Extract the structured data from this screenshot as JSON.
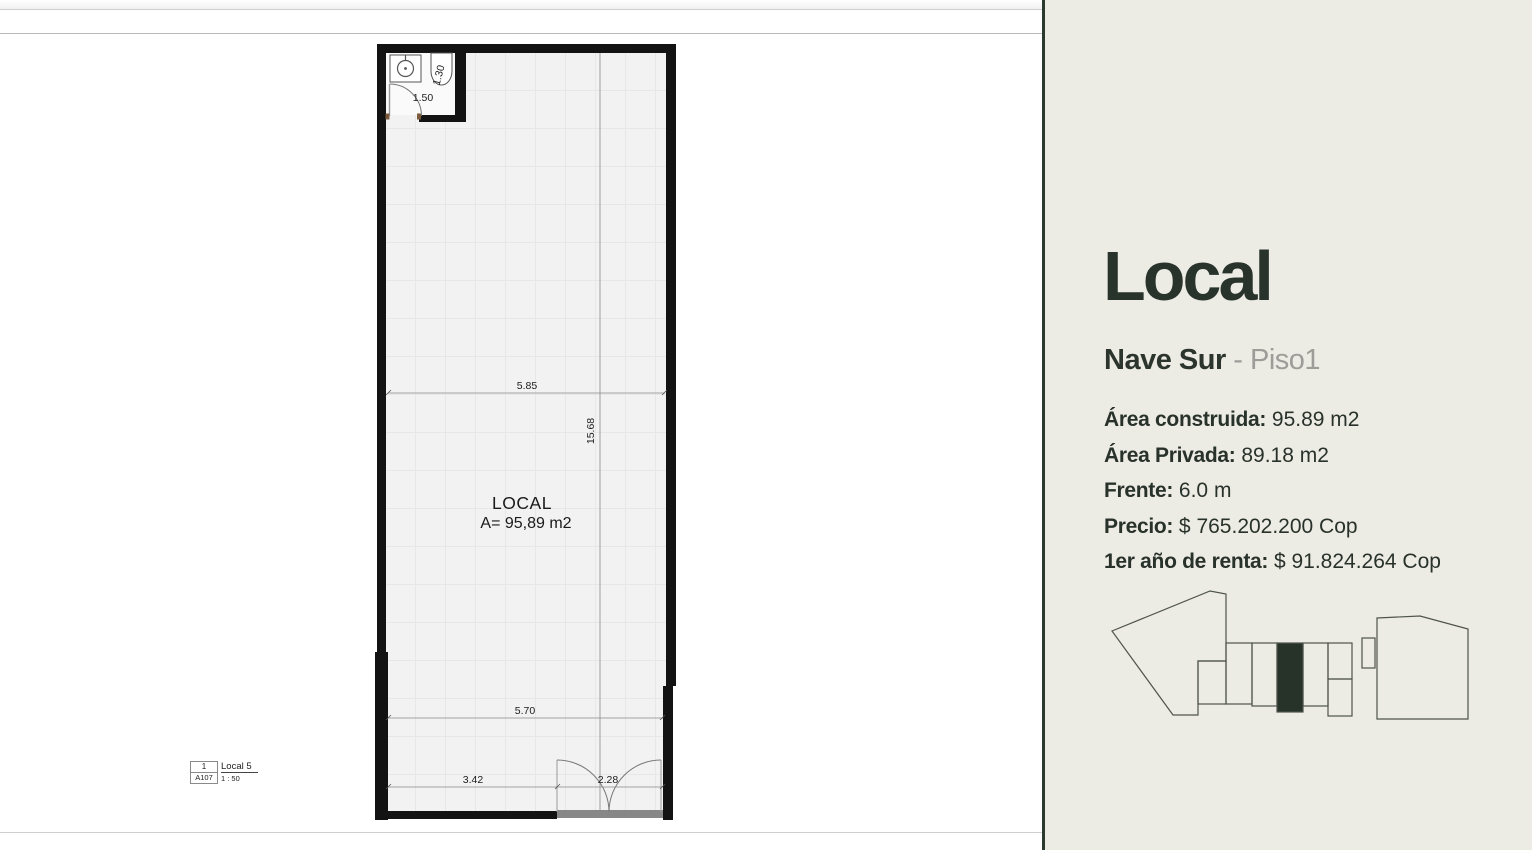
{
  "plan": {
    "room_label": "LOCAL",
    "room_area": "A= 95,89 m2",
    "dims": {
      "width_top": "5.85",
      "height_side": "15.68",
      "width_mid": "5.70",
      "front_left": "3.42",
      "front_door": "2.28",
      "bath_door": "1.50",
      "bath_depth": "1.30"
    },
    "title_block": {
      "view_number": "1",
      "sheet_number": "A107",
      "view_name": "Local 5",
      "scale": "1 : 50"
    }
  },
  "panel": {
    "title": "Local",
    "subtitle_main": "Nave Sur ",
    "subtitle_secondary": "- Piso1",
    "details": [
      {
        "label": "Área construida:",
        "value": " 95.89 m2"
      },
      {
        "label": "Área Privada:",
        "value": " 89.18 m2"
      },
      {
        "label": "Frente:",
        "value": " 6.0 m"
      },
      {
        "label": "Precio:",
        "value": " $ 765.202.200 Cop"
      },
      {
        "label": "1er año de renta:",
        "value": " $ 91.824.264 Cop"
      }
    ],
    "colors": {
      "background": "#edece4",
      "accent_dark": "#28332c",
      "muted_gray": "#9c9c99",
      "highlight_fill": "#273329",
      "wall_black": "#131313"
    }
  }
}
